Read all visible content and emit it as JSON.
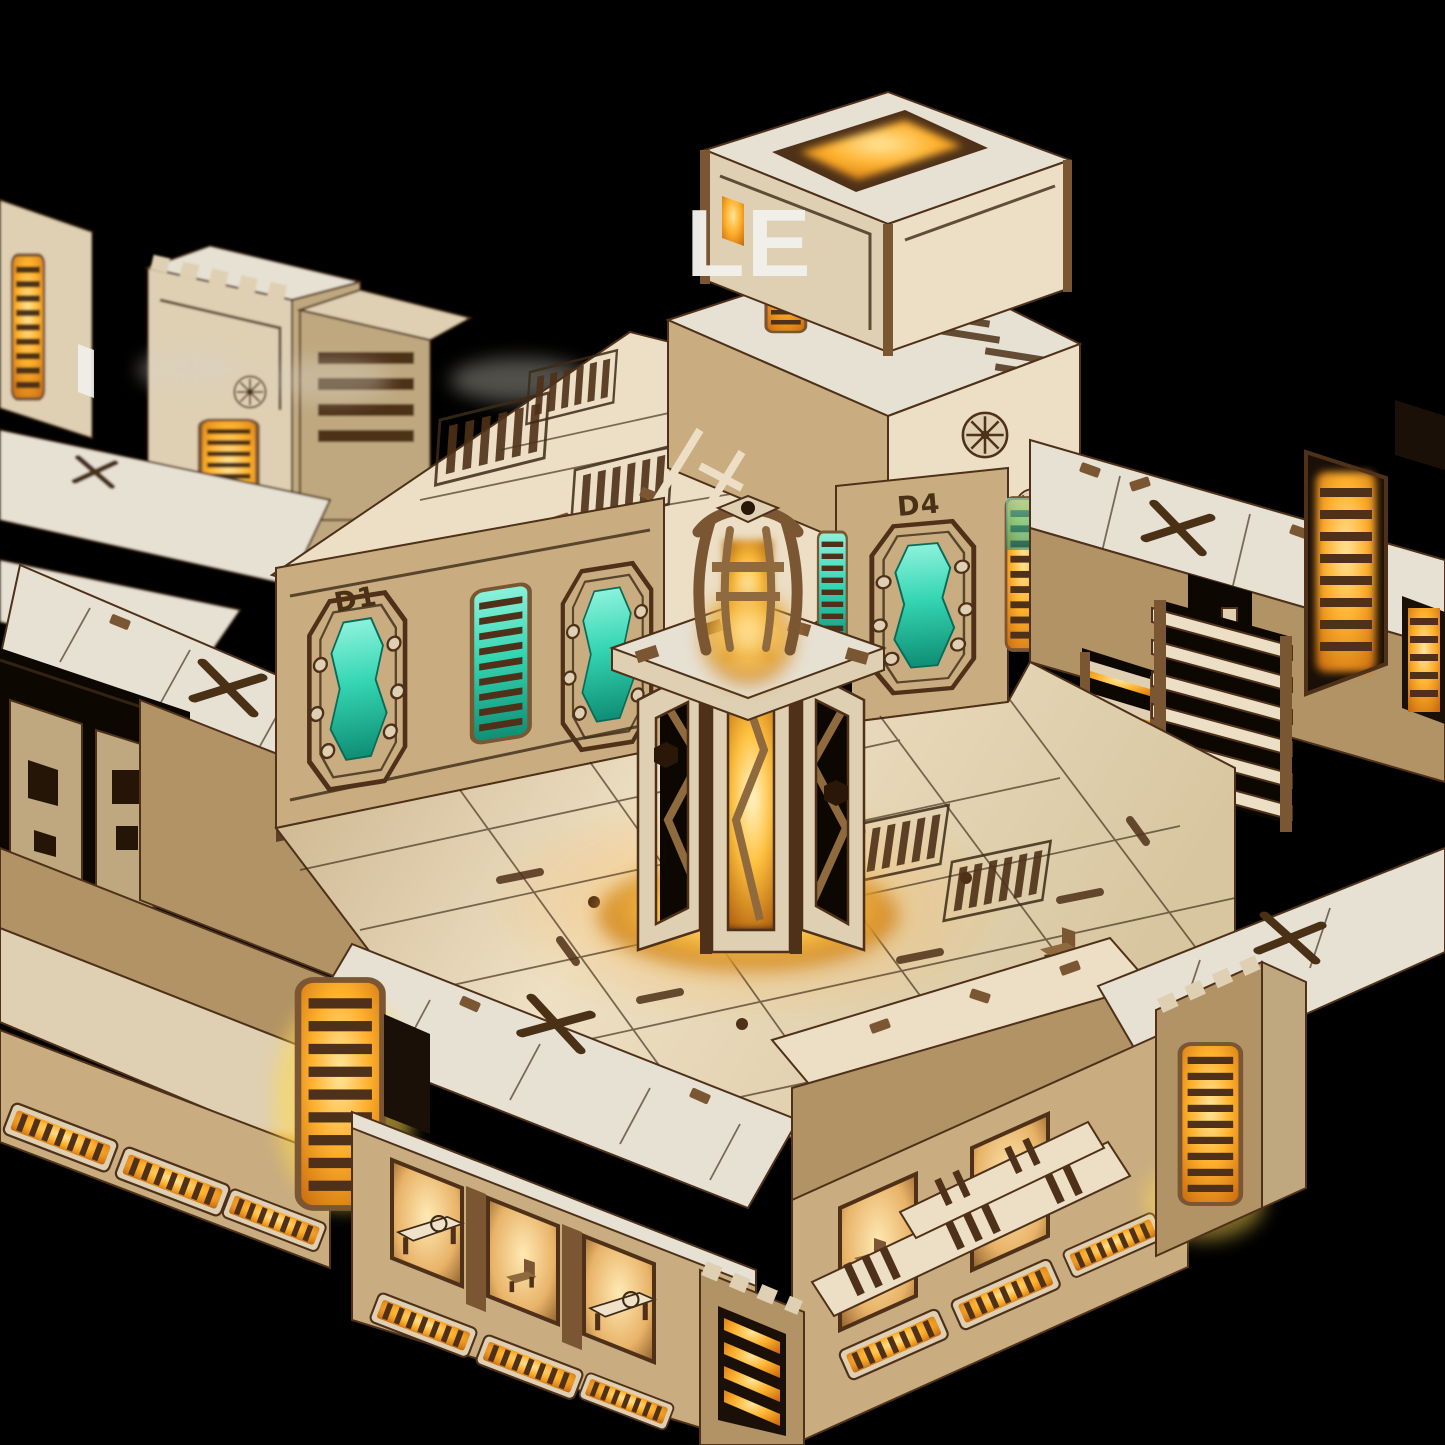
{
  "scene": {
    "aria_label": "Isometric product render of a laser-cut plywood modular sci-fi dungeon terrain set with warm LED lighting, teal glowing doors, an octagonal reactor tower, tiled floors and vented outer walls, on a black background",
    "background": "black"
  },
  "wall_labels": {
    "d1": "D1",
    "d4": "D4"
  },
  "watermark": {
    "visible_text": "LE"
  },
  "colors": {
    "bg": "#000000",
    "plywood": "#dfd0b4",
    "plywood-light": "#ecdfc6",
    "plywood-white": "#e7e1d4",
    "plywood-shadow": "#bfa87f",
    "tan": "#c9ad80",
    "tan-dark": "#b29365",
    "trim": "#7b5633",
    "trim-mid": "#8f6a3e",
    "trim-dark": "#4e3118",
    "etch": "#3c2a16",
    "glow-yellow": "#ffd94d",
    "glow-amber": "#ffb22e",
    "glow-orange": "#ef8c15",
    "glow-deep": "#b85f0b",
    "teal": "#35d6b3",
    "teal-deep": "#0f8e74",
    "interior-warm": "#f7dca6",
    "label": "#4a3014",
    "watermark-white": "#f2f0ec"
  }
}
